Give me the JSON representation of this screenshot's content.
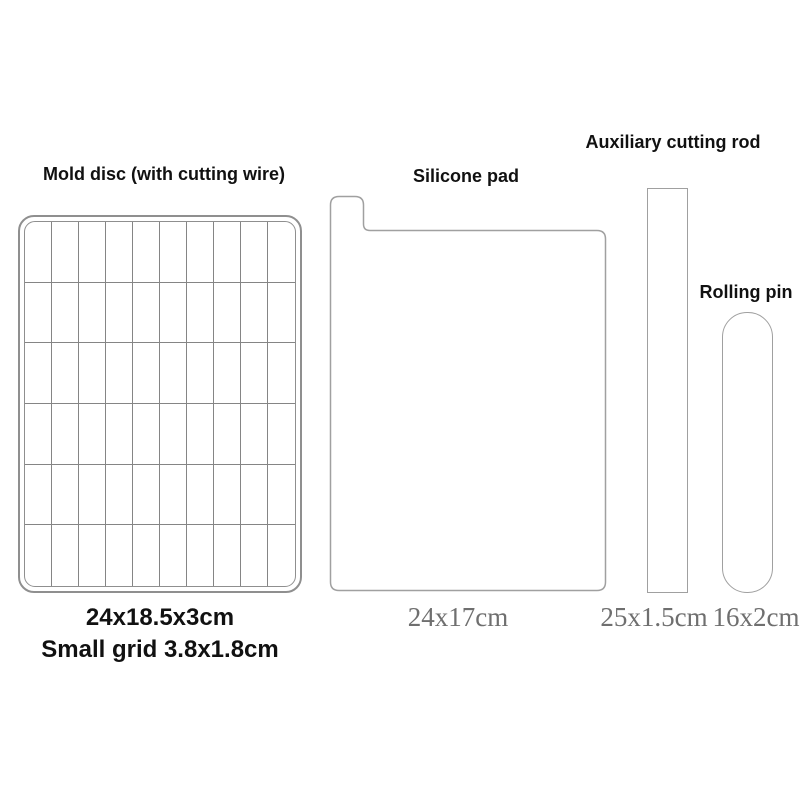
{
  "diagram_title": "Cheese / butter cutting tool parts diagram",
  "colors": {
    "background": "#ffffff",
    "outline": "#8f8f8f",
    "outline_light": "#a0a0a0",
    "grid_line": "#858585",
    "label_text": "#111111",
    "dimension_text": "#6f6f6f"
  },
  "items": [
    {
      "id": "mold-disc",
      "title": "Mold disc (with cutting wire)",
      "dimensions": [
        "24x18.5x3cm",
        "Small grid 3.8x1.8cm"
      ],
      "grid": {
        "columns": 10,
        "rows": 6
      }
    },
    {
      "id": "silicone-pad",
      "title": "Silicone pad",
      "dimensions": [
        "24x17cm"
      ]
    },
    {
      "id": "auxiliary-cutting-rod",
      "title": "Auxiliary cutting rod",
      "dimensions": [
        "25x1.5cm"
      ]
    },
    {
      "id": "rolling-pin",
      "title": "Rolling pin",
      "dimensions": [
        "16x2cm"
      ]
    }
  ]
}
